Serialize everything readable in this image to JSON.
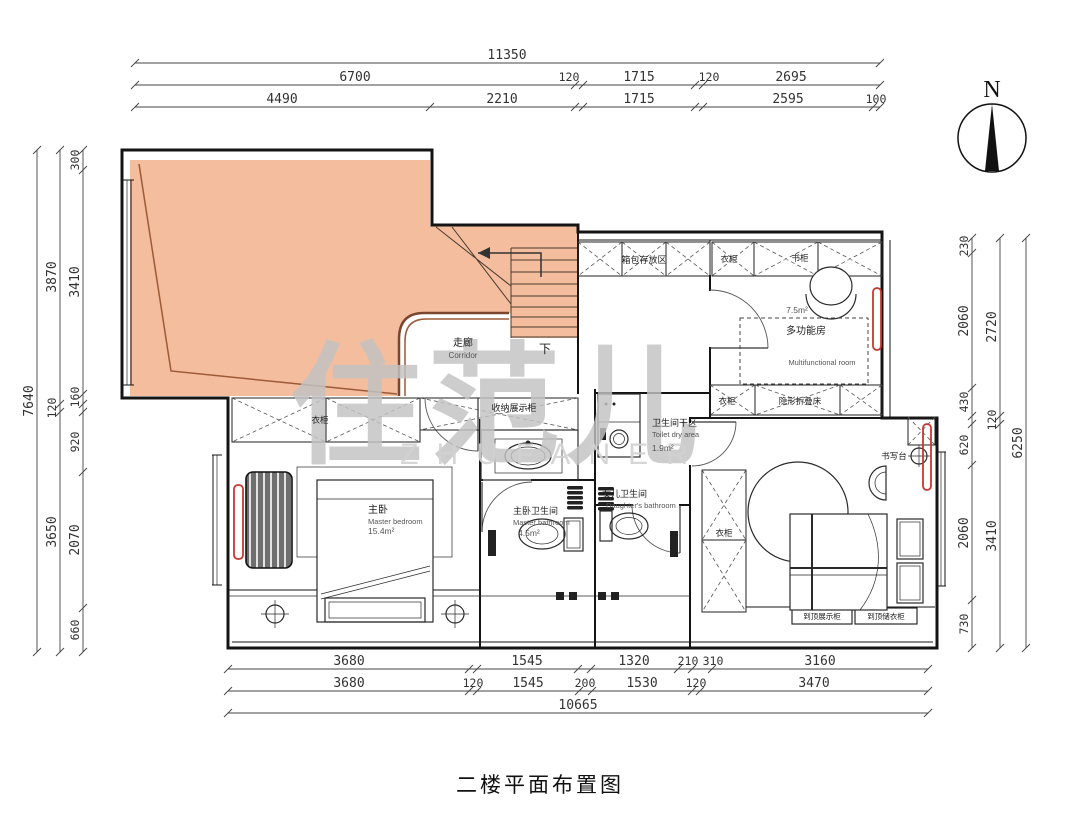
{
  "title": "二楼平面布置图",
  "watermark": {
    "cn": "住范儿",
    "en": "ZHUFANER"
  },
  "compass": {
    "label": "N"
  },
  "dims": {
    "top1": [
      "11350"
    ],
    "top2": [
      "6700",
      "120",
      "1715",
      "120",
      "2695"
    ],
    "top3": [
      "4490",
      "2210",
      "1715",
      "2595",
      "100"
    ],
    "bottom1": [
      "3680",
      "1545",
      "1320",
      "210",
      "310",
      "3160"
    ],
    "bottom2": [
      "3680",
      "120",
      "1545",
      "200",
      "1530",
      "120",
      "3470"
    ],
    "bottom3": [
      "10665"
    ],
    "left_outer": [
      "7640"
    ],
    "left_mid": [
      "3870",
      "120",
      "3650"
    ],
    "left_inner": [
      "300",
      "3410",
      "160",
      "920",
      "2070",
      "660"
    ],
    "right_inner": [
      "230",
      "2060",
      "430",
      "620",
      "2060",
      "730"
    ],
    "right_mid": [
      "2720",
      "120",
      "3410"
    ],
    "right_outer": [
      "6250"
    ]
  },
  "rooms": {
    "corridor": {
      "cn": "走廊",
      "en": "Corridor"
    },
    "stairs_down": "下",
    "luggage": "箱包存放区",
    "storage_display": "收纳展示柜",
    "wardrobe": "衣柜",
    "bookcase": "书柜",
    "folding_bed": "隐形折叠床",
    "mfr": {
      "area": "7.5m²",
      "cn": "多功能房",
      "en": "Multifunctional room"
    },
    "master": {
      "cn": "主卧",
      "en": "Master bedroom",
      "area": "15.4m²"
    },
    "master_bath": {
      "cn": "主卧卫生间",
      "en": "Master bathroom",
      "area": "4.5m²"
    },
    "daughter_bath": {
      "cn": "女儿卫生间",
      "en": "Daughter's bathroom"
    },
    "dry_area": {
      "cn": "卫生间干区",
      "en": "Toilet dry area",
      "area": "1.9m²"
    },
    "desk": "书写台",
    "tag_display": "到顶展示柜",
    "tag_wardrobe": "到顶储衣柜"
  },
  "colors": {
    "void_fill": "#f4bd9d",
    "void_line": "#9c5a38",
    "radiator": "#c4392f",
    "wall": "#141414",
    "watermark": "#c3c3c3"
  }
}
